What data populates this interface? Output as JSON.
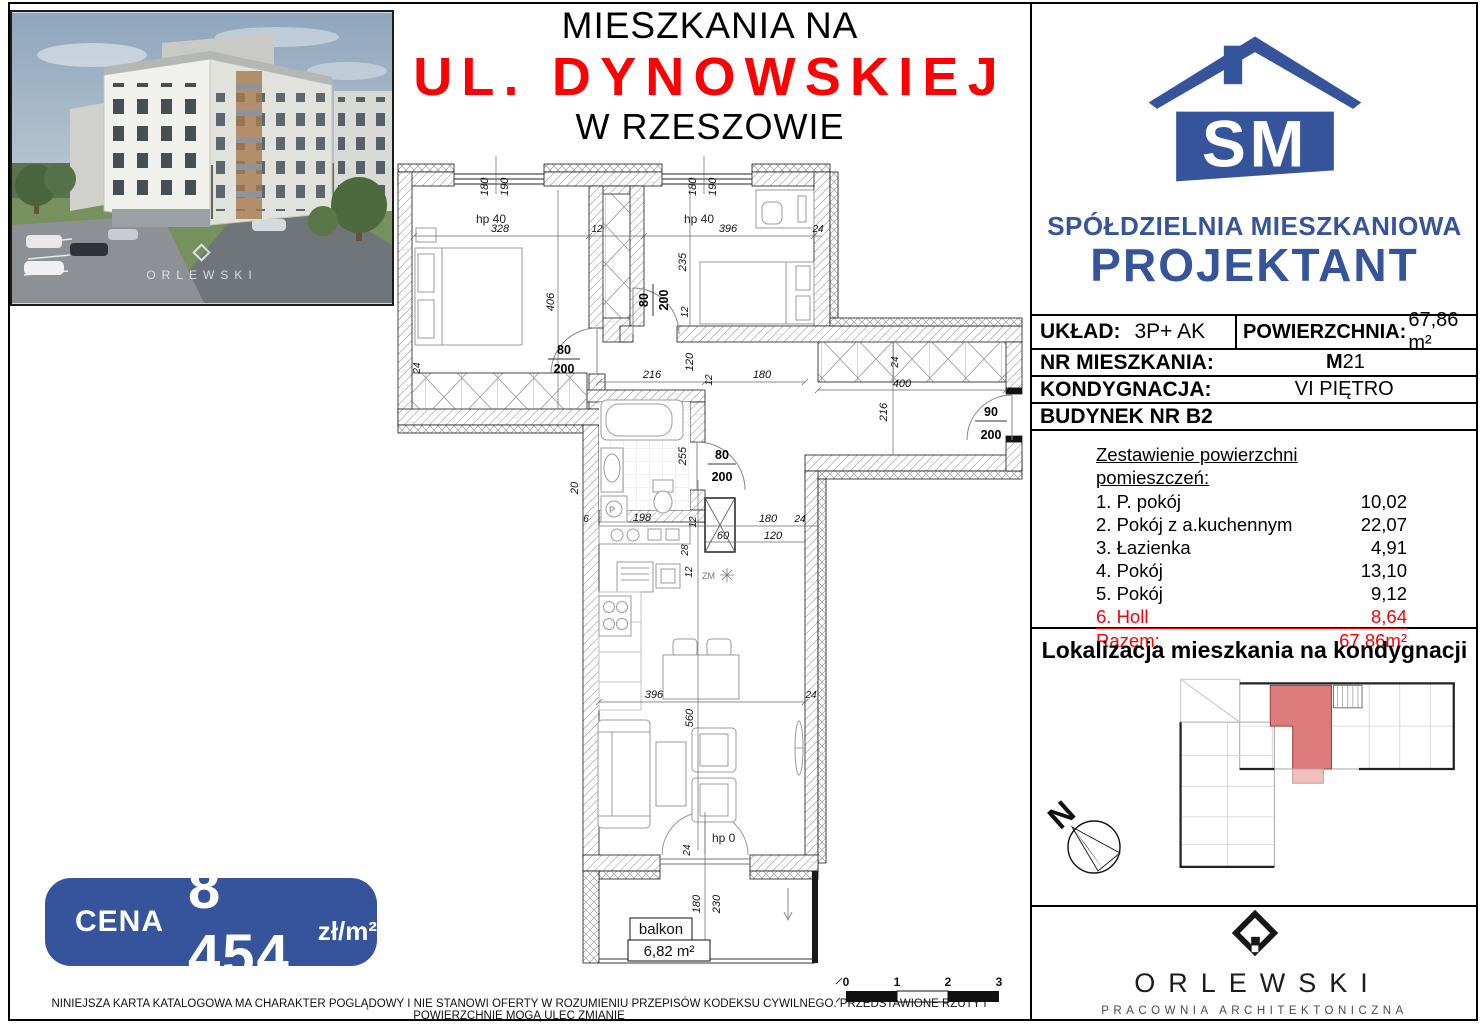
{
  "header": {
    "line1": "MIESZKANIA NA",
    "line2": "UL. DYNOWSKIEJ",
    "line3": "W RZESZOWIE"
  },
  "photo": {
    "watermark": "ORLEWSKI"
  },
  "brand": {
    "coop_line1": "SPÓŁDZIELNIA MIESZKANIOWA",
    "coop_line2": "PROJEKTANT",
    "monogram": "SM"
  },
  "details": {
    "layout_label": "UKŁAD:",
    "layout_value": "3P+ AK",
    "area_label": "POWIERZCHNIA:",
    "area_value": "67,86 m²",
    "apt_label": "NR MIESZKANIA:",
    "apt_value_prefix": "M",
    "apt_value_number": "21",
    "floor_label": "KONDYGNACJA:",
    "floor_value": "VI PIĘTRO",
    "building_label": "BUDYNEK NR B2"
  },
  "rooms": {
    "heading": "Zestawienie powierzchni pomieszczeń:",
    "items": [
      {
        "name": "1. P. pokój",
        "area": "10,02"
      },
      {
        "name": "2. Pokój z a.kuchennym",
        "area": "22,07"
      },
      {
        "name": "3. Łazienka",
        "area": "4,91"
      },
      {
        "name": "4. Pokój",
        "area": "13,10"
      },
      {
        "name": "5. Pokój",
        "area": "9,12"
      },
      {
        "name": "6. Holl",
        "area": "8,64"
      }
    ],
    "total_label": "Razem:",
    "total_value": "67,86m²"
  },
  "location": {
    "heading": "Lokalizacja mieszkania na kondygnacji",
    "compass_letter": "N"
  },
  "architect": {
    "name": "ORLEWSKI",
    "subtitle": "PRACOWNIA ARCHITEKTONICZNA"
  },
  "price": {
    "label": "CENA",
    "value": "8 454",
    "unit": "zł/m²"
  },
  "disclaimer": "NINIEJSZA KARTA KATALOGOWA MA CHARAKTER POGLĄDOWY I NIE STANOWI OFERTY W ROZUMIENIU PRZEPISÓW KODEKSU CYWILNEGO. PRZEDSTAWIONE RZUTY I POWIERZCHNIE MOGĄ ULEC ZMIANIE",
  "plan": {
    "win_a": "180",
    "win_b": "190",
    "hp40": "hp 40",
    "hp0": "hp 0",
    "d328": "328",
    "d406": "406",
    "d396": "396",
    "d235": "235",
    "d12": "12",
    "d24": "24",
    "d216": "216",
    "d400": "400",
    "d120": "120",
    "d180": "180",
    "d255": "255",
    "d198": "198",
    "d20": "20",
    "d6": "6",
    "d28": "28",
    "d60": "60",
    "d560": "560",
    "d230": "230",
    "door_w": "80",
    "door_h": "200",
    "entry_w": "90",
    "washer": "P",
    "zm": "ZM",
    "balcony_label": "balkon",
    "balcony_area": "6,82 m²",
    "scale": [
      "0",
      "1",
      "2",
      "3"
    ]
  },
  "colors": {
    "brand_blue": "#35549b",
    "accent_red": "#fe0000",
    "unit_highlight": "#dc7c7c",
    "unit_balcony_highlight": "#f2bfbf"
  }
}
